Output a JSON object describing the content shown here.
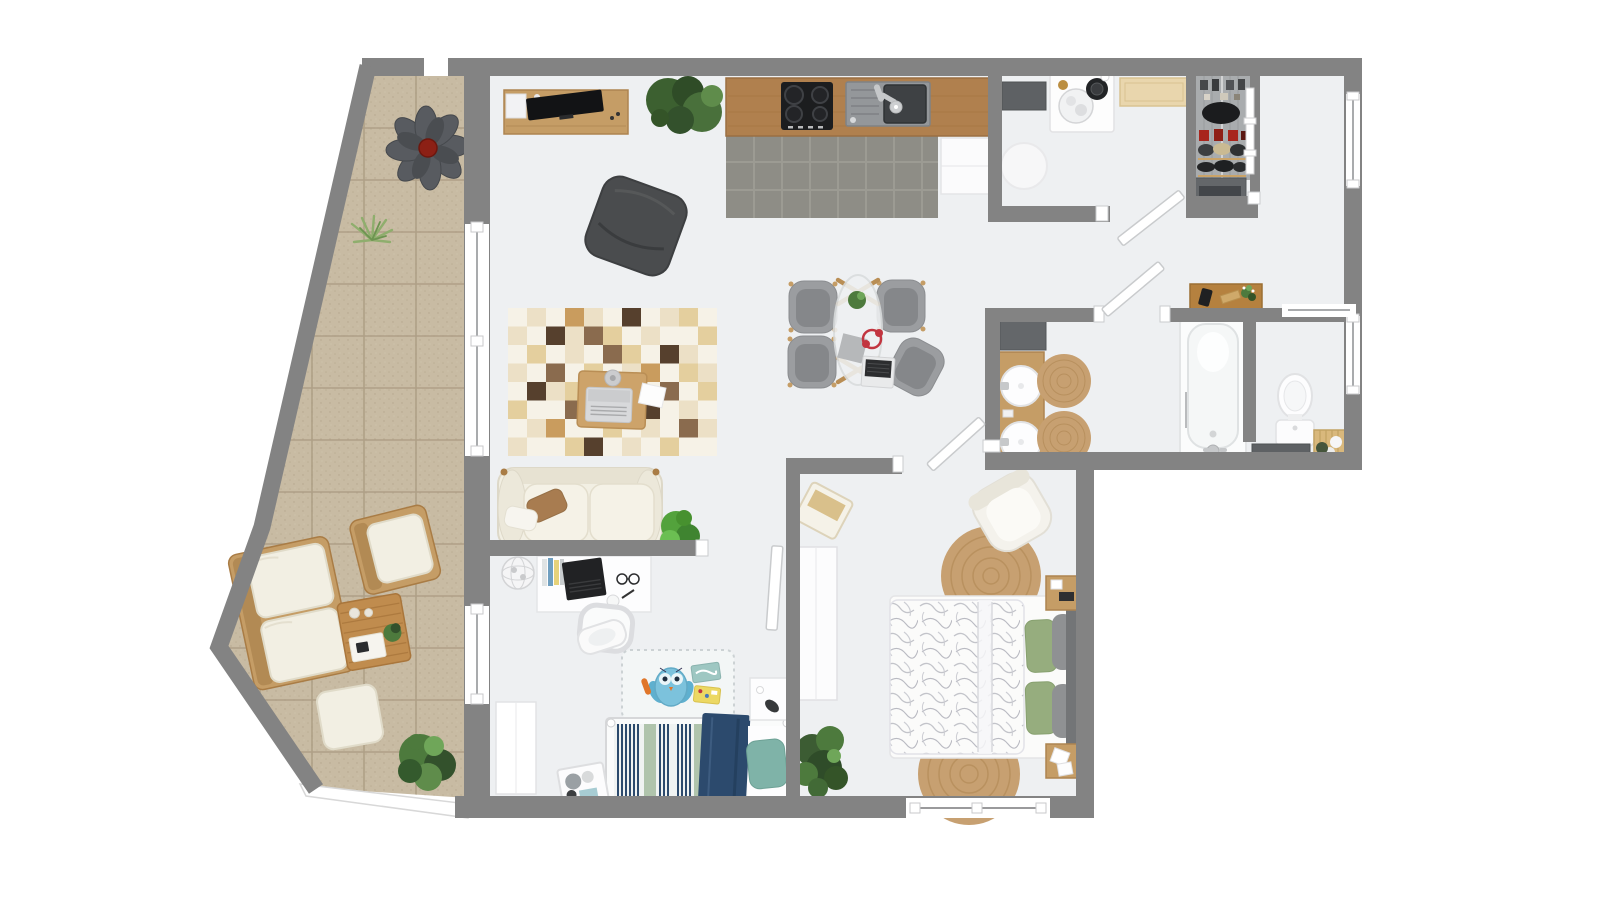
{
  "colors": {
    "wall": "#838383",
    "wallDark": "#6f6f6f",
    "floor": "#eef0f2",
    "outside": "#ffffff",
    "kitchenTile": "#8e8d86",
    "kitchenGrout": "#a09f97",
    "counterWood": "#b0804e",
    "counterWoodDark": "#9a6f42",
    "balconyTile": "#c8bba3",
    "balconyGrout": "#ab9c83",
    "wood": "#c59d66",
    "woodDark": "#a97c45",
    "cream": "#f2efe3",
    "creamShadow": "#e0dbc9",
    "grayChair": "#9b9da0",
    "grayChairDark": "#85878a",
    "charcoal": "#4a4c4e",
    "black": "#1c1d1f",
    "plantDark": "#33512c",
    "plantMid": "#4d7a3d",
    "plantLight": "#6fa659",
    "jute": "#c7a071",
    "juteLine": "#ad8551",
    "navy": "#2c4a6d",
    "teal": "#7fb3a8",
    "tealLight": "#7cc2dc",
    "sage": "#a9bfa4",
    "pillowGreen": "#96ad7e",
    "red": "#a8251c",
    "redAccent": "#c23540",
    "matDark": "#5e6164",
    "steel": "#c6c8ca",
    "white": "#ffffff",
    "lineLight": "#e3e4e6",
    "glass": "#eff1f2",
    "doormat": "#e9d6ad",
    "orange": "#e0762a"
  },
  "rug": {
    "x": 508,
    "y": 308,
    "cell_w": 19,
    "cell_h": 18.5,
    "palette": [
      "#f6f2e7",
      "#ece0c6",
      "#e4cf9e",
      "#c99c5e",
      "#56402d",
      "#8a6b4e",
      "#b9a896"
    ],
    "pattern": [
      "01031040120",
      "10415201002",
      "02010520410",
      "10502013021",
      "04120300502",
      "20051024010",
      "01300201051",
      "10024010200"
    ]
  },
  "scene": {
    "type": "apartment-floor-plan-3d-top-view",
    "rooms": [
      {
        "name": "balcony",
        "furniture": [
          "flower-lounge-chair",
          "outdoor-sofa",
          "outdoor-armchair",
          "outdoor-coffee-table",
          "ottoman",
          "bush-plant",
          "grass-tuft"
        ]
      },
      {
        "name": "living-dining-room",
        "furniture": [
          "sideboard-with-tv",
          "potted-plants",
          "beanbag",
          "patchwork-rug",
          "coffee-table-with-laptop",
          "cream-sofa",
          "dining-table",
          "dining-chairs-x4",
          "work-desk",
          "desk-chair",
          "wire-basket"
        ]
      },
      {
        "name": "kitchen",
        "furniture": [
          "wood-counter",
          "cooktop",
          "sink",
          "fridge-cabinet"
        ]
      },
      {
        "name": "laundry-room",
        "furniture": [
          "washing-machine",
          "counter-mat",
          "round-rug"
        ]
      },
      {
        "name": "entry-hall",
        "furniture": [
          "doormat",
          "wardrobe-closet",
          "sliding-door",
          "shoe-cabinet"
        ]
      },
      {
        "name": "office-room",
        "furniture": [
          "wall-desk",
          "phone",
          "plant-sprig"
        ]
      },
      {
        "name": "bathroom",
        "furniture": [
          "double-sink-vanity",
          "dark-mat",
          "jute-rug-small-x2",
          "bathtub"
        ]
      },
      {
        "name": "wc",
        "furniture": [
          "toilet",
          "bath-mat",
          "laundry-hamper"
        ]
      },
      {
        "name": "kids-bedroom",
        "furniture": [
          "single-bed-striped",
          "play-rug-with-owl",
          "nightstand",
          "toy-box",
          "white-wardrobe",
          "potty-stool"
        ]
      },
      {
        "name": "master-bedroom",
        "furniture": [
          "double-bed-leaf-duvet",
          "jute-rug-x2",
          "nightstand-x2",
          "white-wardrobe",
          "armchair",
          "storage-basket",
          "potted-plant"
        ]
      }
    ],
    "windows": 7,
    "doors": 5
  }
}
